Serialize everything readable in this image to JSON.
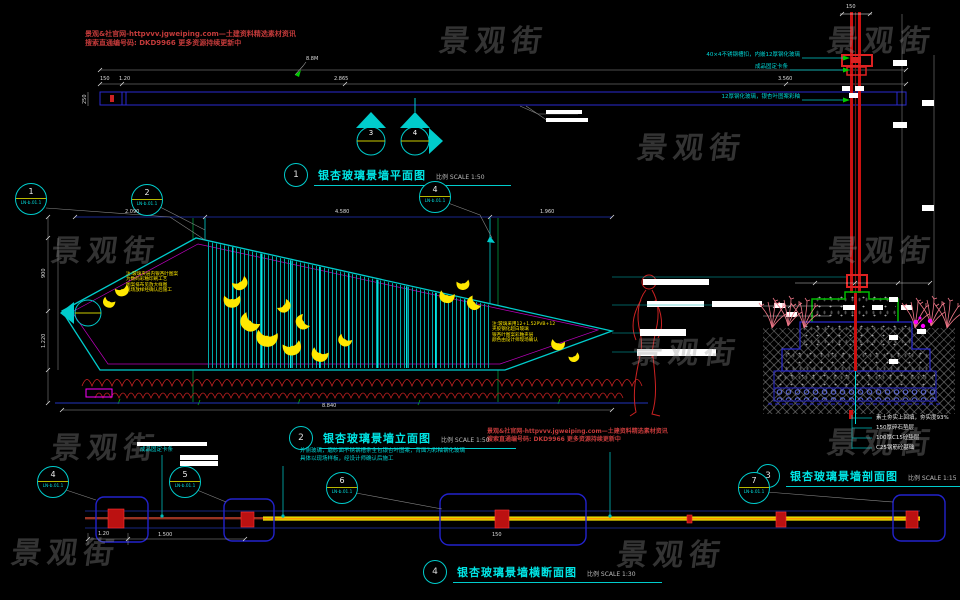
{
  "watermark": {
    "text": "景观街"
  },
  "vendor_note": {
    "line1": "景观&社官网-httpvvv.jgweiping.com—土建资料精选素材资讯",
    "line2": "搜索直通编号码: DKD9966   更多资源持续更新中"
  },
  "titles": {
    "plan": {
      "num": "1",
      "text": "银杏玻璃景墙平面图",
      "scale": "比例 SCALE 1:50"
    },
    "elevation": {
      "num": "2",
      "text": "银杏玻璃景墙立面图",
      "scale": "比例 SCALE 1:50"
    },
    "section": {
      "num": "3",
      "text": "银杏玻璃景墙剖面图",
      "scale": "比例 SCALE 1:15"
    },
    "cross": {
      "num": "4",
      "text": "银杏玻璃景墙横断面图",
      "scale": "比例 SCALE 1:30"
    }
  },
  "callouts": {
    "c1": {
      "num": "1",
      "ref": "LN-b.01.1"
    },
    "c2": {
      "num": "2",
      "ref": "LN-b.01.1"
    },
    "c4": {
      "num": "4",
      "ref": "LN-b.01.1"
    },
    "b1": {
      "num": "4",
      "ref": "LN-b.01.1"
    },
    "b2": {
      "num": "5",
      "ref": "LN-b.01.1"
    },
    "b3": {
      "num": "6",
      "ref": "LN-b.01.1"
    },
    "b4": {
      "num": "7",
      "ref": "LN-b.01.1"
    }
  },
  "plan": {
    "dim_a": "150",
    "dim_b": "1.20",
    "dim_mid": "2.865",
    "dim_right": "3.560",
    "left_dim": "250",
    "leader_label": "8.8M",
    "marker_left_num": "3",
    "marker_right_num": "4"
  },
  "elevation": {
    "top_dims": [
      "2.090",
      "4.580",
      "1.960"
    ],
    "left_dim_a": "900",
    "left_dim_b": "1.220",
    "bottom_dim": "8.840",
    "note_left": [
      "注:玻璃夹层内银杏叶图案",
      "为数码彩釉印刷工艺",
      "图案排布见放大样图",
      "现场放样经确认后施工"
    ],
    "note_right": [
      "注:玻璃采用12+1.52PVB+12",
      "夹胶钢化超白玻璃",
      "银杏叶图案彩釉夹层",
      "颜色由设计师现场确认"
    ]
  },
  "section": {
    "top_dim": "150",
    "ann1": "40×4不锈钢槽扣，内嵌12厚钢化玻璃",
    "ann2": "成品固定卡条",
    "ann3": "12厚钢化玻璃，银杏叶图案彩釉",
    "footing_notes": [
      "素土夯实上回填，夯实度93%",
      "150厚碎石垫层",
      "100厚C15砼垫层",
      "C25钢筋砼基础"
    ]
  },
  "cross": {
    "clamp_label": "成品固定卡条",
    "note1": "外侧玻璃，磨砂面不锈钢槽条全包银杏叶图案，背面为彩釉钢化玻璃",
    "note2": "具体以现场样板，经设计师确认后施工",
    "dim_a": "1.20",
    "dim_b": "1.500",
    "dim_c": "150"
  },
  "colors": {
    "accent_cyan": "#00CCCC",
    "line_blue": "#2A2AD0",
    "red": "#CC1111",
    "leaf_yellow": "#FFE800",
    "magenta": "#FF00FF",
    "green": "#00BB00"
  }
}
